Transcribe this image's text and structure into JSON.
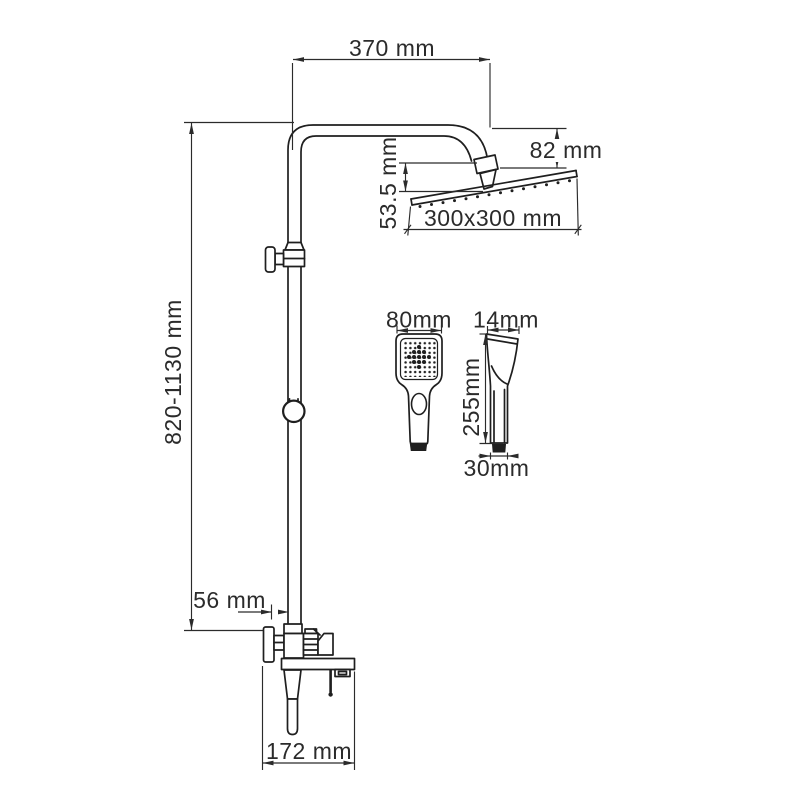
{
  "page": {
    "background": "#ffffff",
    "line_color": "#1f1f1f",
    "text_color": "#2b2b2b"
  },
  "drawing": {
    "labels": {
      "arm_reach": "370 mm",
      "column_height": "820-1130 mm",
      "head_drop": "53.5 mm",
      "head_offset": "82 mm",
      "head_size": "300x300 mm",
      "hand_width": "80mm",
      "hand_depth": "14mm",
      "hand_length": "255mm",
      "hand_base": "30mm",
      "wall_offset": "56 mm",
      "spout_reach": "172 mm"
    }
  }
}
